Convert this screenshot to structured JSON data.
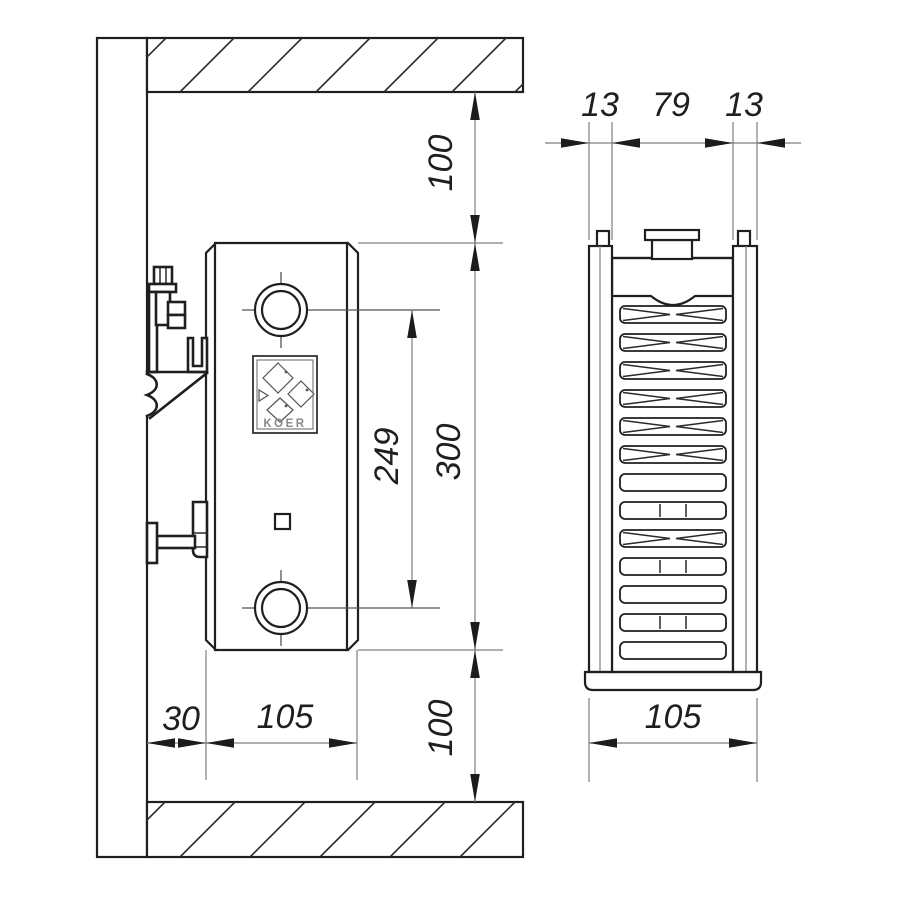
{
  "brand_logo": {
    "text": "KOER"
  },
  "side_view_dims": {
    "top_clearance": "100",
    "radiator_height": "300",
    "port_spacing": "249",
    "bottom_clearance": "100",
    "wall_offset": "30",
    "depth": "105"
  },
  "front_view_dims": {
    "left_panel": "13",
    "core_width": "79",
    "right_panel": "13",
    "overall_depth": "105"
  },
  "colors": {
    "line": "#1f1f1f",
    "dimension_line": "#7f7f7f",
    "panel_fill": "#e6e6e6",
    "header_fill": "#dcdcdc",
    "base_fill": "#d9d9d9"
  }
}
